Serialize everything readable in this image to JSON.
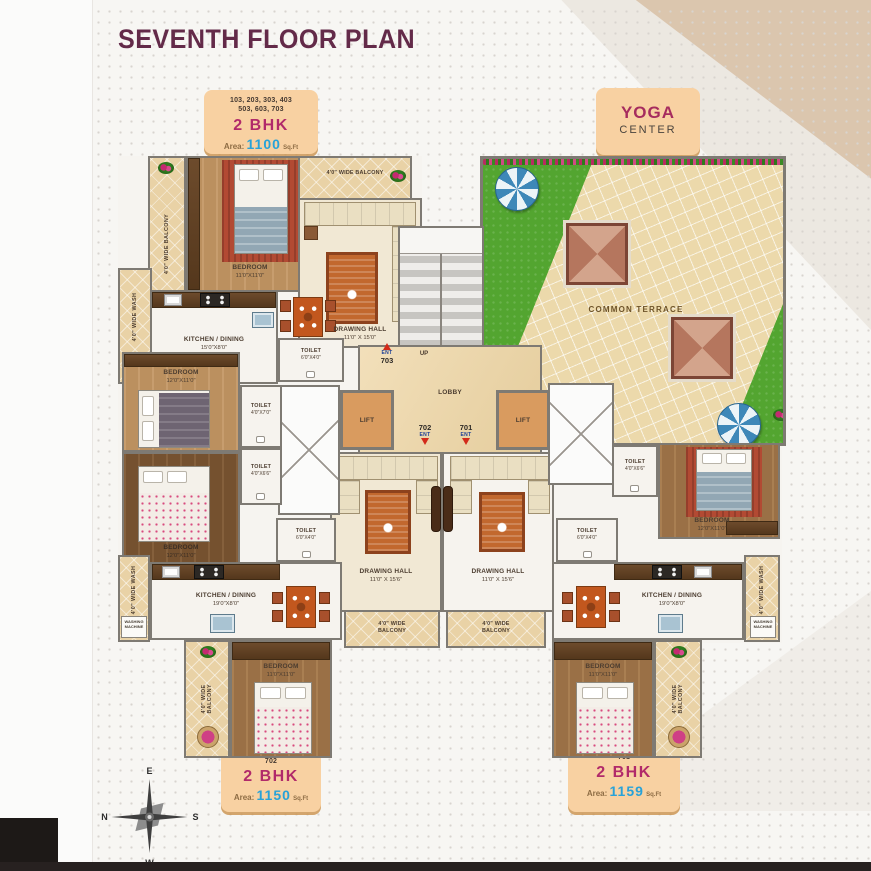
{
  "title": "SEVENTH FLOOR PLAN",
  "badges": {
    "top": {
      "units_line1": "103, 203, 303, 403",
      "units_line2": "503, 603, 703",
      "type": "2 BHK",
      "area_label": "Area:",
      "area_value": "1100",
      "area_unit": "Sq.Ft"
    },
    "yoga": {
      "line1": "YOGA",
      "line2": "CENTER"
    },
    "b702": {
      "unit": "702",
      "type": "2 BHK",
      "area_label": "Area:",
      "area_value": "1150",
      "area_unit": "Sq.Ft"
    },
    "b701": {
      "unit": "701",
      "type": "2 BHK",
      "area_label": "Area:",
      "area_value": "1159",
      "area_unit": "Sq.Ft"
    }
  },
  "rooms": {
    "bedroom_703": {
      "name": "BEDROOM",
      "dim": "11'0\"X11'0\""
    },
    "bedroom_l2": {
      "name": "BEDROOM",
      "dim": "12'0\"X11'0\""
    },
    "bedroom_l3": {
      "name": "BEDROOM",
      "dim": "12'0\"X11'0\""
    },
    "bedroom_r2": {
      "name": "BEDROOM",
      "dim": "12'0\"X11'0\""
    },
    "bedroom_702": {
      "name": "BEDROOM",
      "dim": "11'0\"X11'0\""
    },
    "bedroom_701": {
      "name": "BEDROOM",
      "dim": "11'0\"X11'0\""
    },
    "drawing_703": {
      "name": "DRAWING HALL",
      "dim": "11'0\" X 15'0\""
    },
    "drawing_702": {
      "name": "DRAWING HALL",
      "dim": "11'0\" X 15'6\""
    },
    "drawing_701": {
      "name": "DRAWING HALL",
      "dim": "11'0\" X 15'6\""
    },
    "kitchen_703": {
      "name": "KITCHEN / DINING",
      "dim": "15'0\"X8'0\""
    },
    "kitchen_702": {
      "name": "KITCHEN / DINING",
      "dim": "19'0\"X8'0\""
    },
    "kitchen_701": {
      "name": "KITCHEN / DINING",
      "dim": "19'0\"X8'0\""
    },
    "toilet_t1": {
      "name": "TOILET",
      "dim": "6'0\"X4'0\""
    },
    "toilet_t2": {
      "name": "TOILET",
      "dim": "4'0\"X7'0\""
    },
    "toilet_t3": {
      "name": "TOILET",
      "dim": "4'0\"X6'6\""
    },
    "toilet_t4": {
      "name": "TOILET",
      "dim": "6'0\"X4'0\""
    },
    "toilet_r1": {
      "name": "TOILET",
      "dim": "4'0\"X6'6\""
    },
    "toilet_r2": {
      "name": "TOILET",
      "dim": "6'0\"X4'0\""
    },
    "balcony": "4'0\" WIDE BALCONY",
    "wash": "4'0\" WIDE WASH",
    "washing_machine": "WASHING MACHINE",
    "lobby": "LOBBY",
    "lift": "LIFT",
    "up": "UP",
    "terrace": "COMMON TERRACE",
    "ent": "ENT",
    "unit_703": "703",
    "unit_702": "702",
    "unit_701": "701"
  },
  "compass": {
    "e": "E",
    "n": "N",
    "s": "S",
    "w": "W"
  },
  "colors": {
    "title": "#632a49",
    "accent_pink": "#b12a6a",
    "accent_blue": "#28a2d8",
    "badge_bg": "#f8d1a2",
    "grass": "#53a530",
    "wall": "#7e7a73",
    "ent_red": "#d32a1a"
  }
}
